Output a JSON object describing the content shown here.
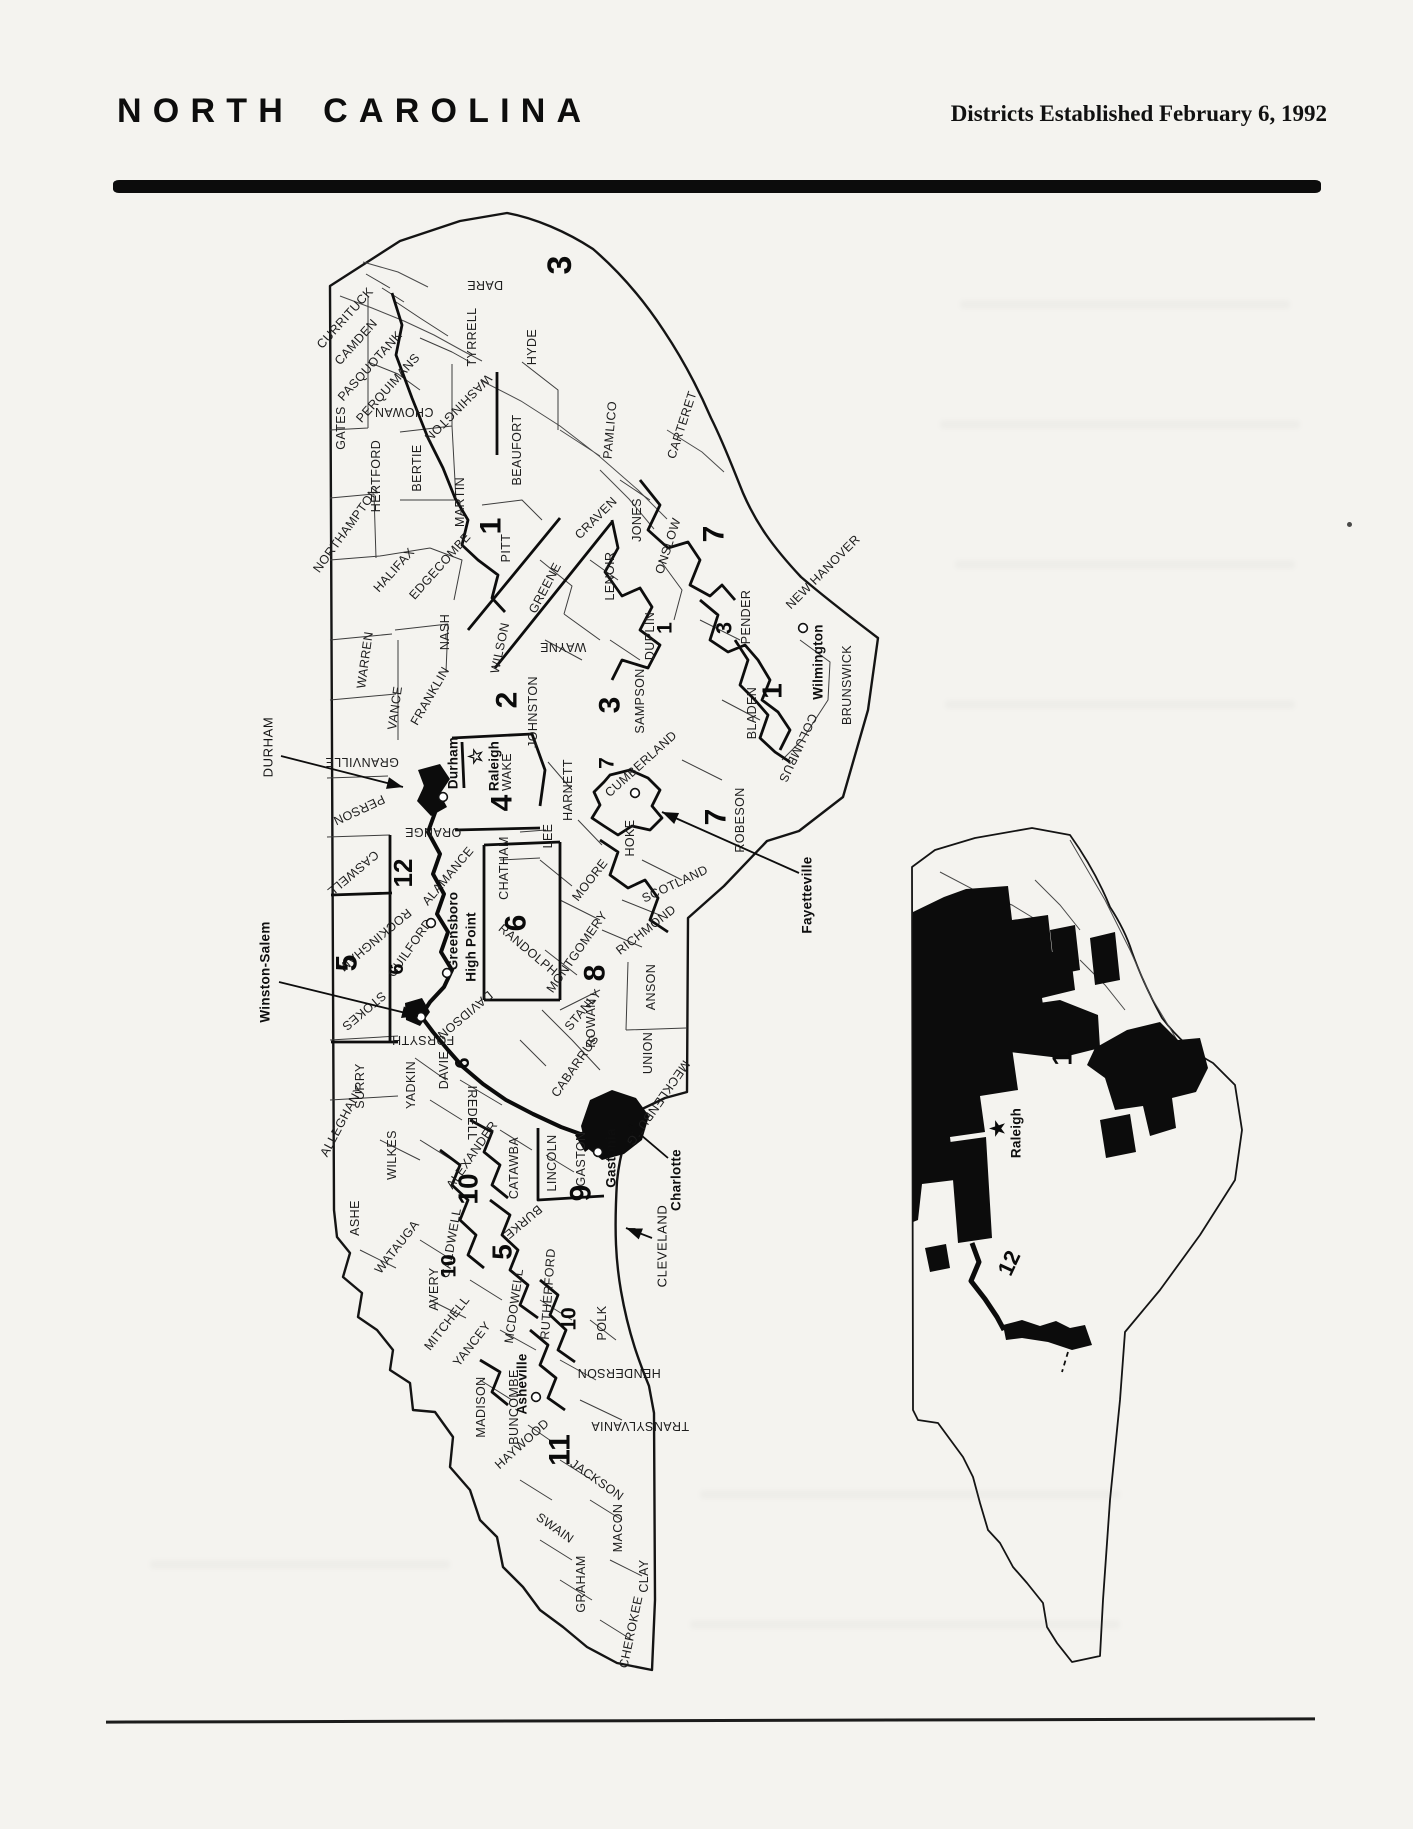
{
  "header": {
    "title": "NORTH CAROLINA",
    "subtitle": "Districts Established February 6, 1992"
  },
  "main_map": {
    "county_labels": [
      {
        "t": "CURRITUCK",
        "x": 345,
        "y": 318,
        "r": -48
      },
      {
        "t": "CAMDEN",
        "x": 356,
        "y": 342,
        "r": -48
      },
      {
        "t": "PASQUOTANK",
        "x": 370,
        "y": 366,
        "r": -48
      },
      {
        "t": "PERQUIMANS",
        "x": 388,
        "y": 388,
        "r": -48
      },
      {
        "t": "CHOWAN",
        "x": 404,
        "y": 412,
        "r": 180
      },
      {
        "t": "GATES",
        "x": 341,
        "y": 428,
        "r": -90
      },
      {
        "t": "DARE",
        "x": 485,
        "y": 285,
        "r": 180
      },
      {
        "t": "TYRRELL",
        "x": 472,
        "y": 337,
        "r": -90
      },
      {
        "t": "HYDE",
        "x": 532,
        "y": 347,
        "r": -90
      },
      {
        "t": "WASHINGTON",
        "x": 458,
        "y": 408,
        "r": 135
      },
      {
        "t": "HERTFORD",
        "x": 376,
        "y": 476,
        "r": -90
      },
      {
        "t": "BERTIE",
        "x": 417,
        "y": 468,
        "r": -90
      },
      {
        "t": "NORTHAMPTON",
        "x": 346,
        "y": 530,
        "r": -54
      },
      {
        "t": "HALIFAX",
        "x": 394,
        "y": 570,
        "r": -48
      },
      {
        "t": "EDGECOMBE",
        "x": 440,
        "y": 566,
        "r": -48
      },
      {
        "t": "MARTIN",
        "x": 460,
        "y": 502,
        "r": -90
      },
      {
        "t": "PITT",
        "x": 506,
        "y": 548,
        "r": -90
      },
      {
        "t": "BEAUFORT",
        "x": 517,
        "y": 450,
        "r": -90
      },
      {
        "t": "PAMLICO",
        "x": 610,
        "y": 430,
        "r": -85
      },
      {
        "t": "CARTERET",
        "x": 682,
        "y": 425,
        "r": -72
      },
      {
        "t": "CRAVEN",
        "x": 596,
        "y": 518,
        "r": -45
      },
      {
        "t": "JONES",
        "x": 637,
        "y": 520,
        "r": -90
      },
      {
        "t": "GREENE",
        "x": 545,
        "y": 588,
        "r": -62
      },
      {
        "t": "LENOIR",
        "x": 610,
        "y": 576,
        "r": -90
      },
      {
        "t": "ONSLOW",
        "x": 668,
        "y": 546,
        "r": -72
      },
      {
        "t": "DUPLIN",
        "x": 650,
        "y": 636,
        "r": -90
      },
      {
        "t": "PENDER",
        "x": 746,
        "y": 617,
        "r": -90
      },
      {
        "t": "NEW HANOVER",
        "x": 823,
        "y": 572,
        "r": -45
      },
      {
        "t": "BRUNSWICK",
        "x": 847,
        "y": 685,
        "r": -90
      },
      {
        "t": "COLUMBUS",
        "x": 798,
        "y": 748,
        "r": 115
      },
      {
        "t": "BLADEN",
        "x": 752,
        "y": 713,
        "r": -90
      },
      {
        "t": "SAMPSON",
        "x": 640,
        "y": 701,
        "r": -90
      },
      {
        "t": "WAYNE",
        "x": 563,
        "y": 647,
        "r": 180
      },
      {
        "t": "WILSON",
        "x": 500,
        "y": 648,
        "r": -78
      },
      {
        "t": "NASH",
        "x": 445,
        "y": 632,
        "r": -90
      },
      {
        "t": "WARREN",
        "x": 365,
        "y": 660,
        "r": -82
      },
      {
        "t": "VANCE",
        "x": 395,
        "y": 708,
        "r": -82
      },
      {
        "t": "FRANKLIN",
        "x": 430,
        "y": 696,
        "r": -60
      },
      {
        "t": "GRANVILLE",
        "x": 362,
        "y": 762,
        "r": 180
      },
      {
        "t": "PERSON",
        "x": 359,
        "y": 810,
        "r": 155
      },
      {
        "t": "CASWELL",
        "x": 353,
        "y": 873,
        "r": 140
      },
      {
        "t": "ORANGE",
        "x": 433,
        "y": 832,
        "r": 180
      },
      {
        "t": "ALAMANCE",
        "x": 448,
        "y": 876,
        "r": -50
      },
      {
        "t": "WAKE",
        "x": 507,
        "y": 772,
        "r": -90
      },
      {
        "t": "JOHNSTON",
        "x": 533,
        "y": 712,
        "r": -90
      },
      {
        "t": "HARNETT",
        "x": 568,
        "y": 790,
        "r": -90
      },
      {
        "t": "CUMBERLAND",
        "x": 641,
        "y": 764,
        "r": -42
      },
      {
        "t": "HOKE",
        "x": 630,
        "y": 838,
        "r": -90
      },
      {
        "t": "ROBESON",
        "x": 740,
        "y": 820,
        "r": -90
      },
      {
        "t": "SCOTLAND",
        "x": 675,
        "y": 884,
        "r": -25
      },
      {
        "t": "RICHMOND",
        "x": 646,
        "y": 930,
        "r": -38
      },
      {
        "t": "MOORE",
        "x": 590,
        "y": 880,
        "r": -52
      },
      {
        "t": "LEE",
        "x": 548,
        "y": 836,
        "r": -90
      },
      {
        "t": "CHATHAM",
        "x": 504,
        "y": 868,
        "r": -90
      },
      {
        "t": "MONTGOMERY",
        "x": 577,
        "y": 952,
        "r": -55
      },
      {
        "t": "STANLY",
        "x": 583,
        "y": 1010,
        "r": -50
      },
      {
        "t": "ANSON",
        "x": 651,
        "y": 987,
        "r": -90
      },
      {
        "t": "UNION",
        "x": 648,
        "y": 1053,
        "r": -90
      },
      {
        "t": "CABARRUS",
        "x": 575,
        "y": 1066,
        "r": -55
      },
      {
        "t": "ROWAN",
        "x": 591,
        "y": 1023,
        "r": -90
      },
      {
        "t": "DAVIDSON",
        "x": 465,
        "y": 1015,
        "r": 140
      },
      {
        "t": "RANDOLPH",
        "x": 528,
        "y": 950,
        "r": 40
      },
      {
        "t": "GUILFORD",
        "x": 410,
        "y": 948,
        "r": -55
      },
      {
        "t": "ROCKINGHAM",
        "x": 375,
        "y": 940,
        "r": 140
      },
      {
        "t": "STOKES",
        "x": 364,
        "y": 1011,
        "r": 140
      },
      {
        "t": "SURRY",
        "x": 360,
        "y": 1086,
        "r": -90
      },
      {
        "t": "YADKIN",
        "x": 411,
        "y": 1085,
        "r": -90
      },
      {
        "t": "DAVIE",
        "x": 444,
        "y": 1070,
        "r": -90
      },
      {
        "t": "FORSYTH",
        "x": 423,
        "y": 1040,
        "r": 180
      },
      {
        "t": "IREDELL",
        "x": 472,
        "y": 1113,
        "r": 90
      },
      {
        "t": "MECKLENBURG",
        "x": 658,
        "y": 1103,
        "r": 125
      },
      {
        "t": "GASTON",
        "x": 581,
        "y": 1159,
        "r": -90
      },
      {
        "t": "LINCOLN",
        "x": 552,
        "y": 1163,
        "r": -90
      },
      {
        "t": "CATAWBA",
        "x": 514,
        "y": 1168,
        "r": -90
      },
      {
        "t": "ALEXANDER",
        "x": 472,
        "y": 1155,
        "r": -55
      },
      {
        "t": "WILKES",
        "x": 392,
        "y": 1155,
        "r": -90
      },
      {
        "t": "ALLEGHANY",
        "x": 342,
        "y": 1121,
        "r": -62
      },
      {
        "t": "ASHE",
        "x": 355,
        "y": 1218,
        "r": -90
      },
      {
        "t": "WATAUGA",
        "x": 397,
        "y": 1247,
        "r": -52
      },
      {
        "t": "CALDWELL",
        "x": 451,
        "y": 1243,
        "r": -80
      },
      {
        "t": "AVERY",
        "x": 434,
        "y": 1289,
        "r": -90
      },
      {
        "t": "BURKE",
        "x": 523,
        "y": 1222,
        "r": 140
      },
      {
        "t": "MITCHELL",
        "x": 447,
        "y": 1323,
        "r": -52
      },
      {
        "t": "YANCEY",
        "x": 472,
        "y": 1344,
        "r": -52
      },
      {
        "t": "MCDOWELL",
        "x": 514,
        "y": 1306,
        "r": -82
      },
      {
        "t": "RUTHERFORD",
        "x": 548,
        "y": 1294,
        "r": -86
      },
      {
        "t": "POLK",
        "x": 602,
        "y": 1323,
        "r": -90
      },
      {
        "t": "HENDERSON",
        "x": 619,
        "y": 1373,
        "r": 180
      },
      {
        "t": "MADISON",
        "x": 481,
        "y": 1407,
        "r": -90
      },
      {
        "t": "BUNCOMBE",
        "x": 514,
        "y": 1407,
        "r": -90
      },
      {
        "t": "HAYWOOD",
        "x": 522,
        "y": 1444,
        "r": -42
      },
      {
        "t": "TRANSYLVANIA",
        "x": 640,
        "y": 1426,
        "r": 180
      },
      {
        "t": "JACKSON",
        "x": 597,
        "y": 1480,
        "r": 35
      },
      {
        "t": "SWAIN",
        "x": 555,
        "y": 1528,
        "r": 35
      },
      {
        "t": "MACON",
        "x": 618,
        "y": 1528,
        "r": -90
      },
      {
        "t": "GRAHAM",
        "x": 581,
        "y": 1584,
        "r": -90
      },
      {
        "t": "CLAY",
        "x": 644,
        "y": 1576,
        "r": -90
      },
      {
        "t": "CHEROKEE",
        "x": 631,
        "y": 1632,
        "r": -78
      }
    ],
    "district_labels": [
      {
        "t": "3",
        "x": 560,
        "y": 265,
        "r": -90,
        "s": 34
      },
      {
        "t": "1",
        "x": 491,
        "y": 526,
        "r": -90,
        "s": 30
      },
      {
        "t": "7",
        "x": 714,
        "y": 534,
        "r": -90,
        "s": 30
      },
      {
        "t": "1",
        "x": 665,
        "y": 628,
        "r": -90,
        "s": 21
      },
      {
        "t": "3",
        "x": 724,
        "y": 628,
        "r": -90,
        "s": 22
      },
      {
        "t": "2",
        "x": 507,
        "y": 700,
        "r": -90,
        "s": 30
      },
      {
        "t": "3",
        "x": 610,
        "y": 705,
        "r": -90,
        "s": 30
      },
      {
        "t": "1",
        "x": 772,
        "y": 691,
        "r": -90,
        "s": 28
      },
      {
        "t": "7",
        "x": 607,
        "y": 763,
        "r": -90,
        "s": 21
      },
      {
        "t": "7",
        "x": 716,
        "y": 817,
        "r": -90,
        "s": 30
      },
      {
        "t": "4",
        "x": 502,
        "y": 803,
        "r": -90,
        "s": 30
      },
      {
        "t": "12",
        "x": 403,
        "y": 873,
        "r": -90,
        "s": 26
      },
      {
        "t": "5",
        "x": 347,
        "y": 963,
        "r": -90,
        "s": 30
      },
      {
        "t": "6",
        "x": 397,
        "y": 969,
        "r": -90,
        "s": 20
      },
      {
        "t": "6",
        "x": 516,
        "y": 923,
        "r": -90,
        "s": 30
      },
      {
        "t": "8",
        "x": 595,
        "y": 973,
        "r": -90,
        "s": 30
      },
      {
        "t": "6",
        "x": 463,
        "y": 1063,
        "r": -90,
        "s": 20
      },
      {
        "t": "10",
        "x": 468,
        "y": 1189,
        "r": -90,
        "s": 28
      },
      {
        "t": "9",
        "x": 581,
        "y": 1193,
        "r": -90,
        "s": 30
      },
      {
        "t": "5",
        "x": 502,
        "y": 1252,
        "r": -90,
        "s": 28
      },
      {
        "t": "10",
        "x": 449,
        "y": 1266,
        "r": -90,
        "s": 21
      },
      {
        "t": "10",
        "x": 569,
        "y": 1319,
        "r": -90,
        "s": 21
      },
      {
        "t": "11",
        "x": 560,
        "y": 1450,
        "r": -90,
        "s": 30
      }
    ],
    "city_labels": [
      {
        "t": "Raleigh",
        "x": 494,
        "y": 766,
        "r": -90
      },
      {
        "t": "Durham",
        "x": 453,
        "y": 763,
        "r": -90
      },
      {
        "t": "Greensboro",
        "x": 453,
        "y": 931,
        "r": -90
      },
      {
        "t": "High Point",
        "x": 471,
        "y": 947,
        "r": -90
      },
      {
        "t": "Wilmington",
        "x": 818,
        "y": 662,
        "r": -90
      },
      {
        "t": "Gastonia",
        "x": 611,
        "y": 1158,
        "r": -90
      },
      {
        "t": "Asheville",
        "x": 522,
        "y": 1384,
        "r": -90
      }
    ],
    "markers": [
      {
        "type": "star",
        "glyph": "☆",
        "x": 476,
        "y": 757
      },
      {
        "type": "circle",
        "x": 443,
        "y": 797
      },
      {
        "type": "circle",
        "x": 431,
        "y": 923
      },
      {
        "type": "circle",
        "x": 447,
        "y": 973
      },
      {
        "type": "circle",
        "x": 421,
        "y": 1017
      },
      {
        "type": "circle",
        "x": 598,
        "y": 1152
      },
      {
        "type": "circle",
        "x": 536,
        "y": 1397
      },
      {
        "type": "circle",
        "x": 803,
        "y": 628
      },
      {
        "type": "circle",
        "x": 635,
        "y": 793
      }
    ],
    "callouts": [
      {
        "t": "DURHAM",
        "x": 268,
        "y": 747,
        "r": -90,
        "b": 0,
        "ax1": 281,
        "ay1": 756,
        "ax2": 403,
        "ay2": 787
      },
      {
        "t": "Winston-Salem",
        "x": 265,
        "y": 972,
        "r": -90,
        "b": 1,
        "ax1": 279,
        "ay1": 982,
        "ax2": 418,
        "ay2": 1016
      },
      {
        "t": "Fayetteville",
        "x": 807,
        "y": 895,
        "r": -90,
        "b": 1,
        "ax1": 799,
        "ay1": 873,
        "ax2": 662,
        "ay2": 812
      },
      {
        "t": "Charlotte",
        "x": 676,
        "y": 1180,
        "r": -90,
        "b": 1,
        "ax1": 668,
        "ay1": 1158,
        "ax2": 628,
        "ay2": 1124
      },
      {
        "t": "CLEVELAND",
        "x": 662,
        "y": 1246,
        "r": -90,
        "b": 0,
        "ax1": 652,
        "ay1": 1238,
        "ax2": 626,
        "ay2": 1228
      }
    ]
  },
  "inset_map": {
    "district_labels": [
      {
        "t": "1",
        "x": 1062,
        "y": 1058,
        "r": -90,
        "s": 28
      },
      {
        "t": "12",
        "x": 1009,
        "y": 1263,
        "r": -65,
        "s": 22
      }
    ],
    "city_labels": [
      {
        "t": "Raleigh",
        "x": 1016,
        "y": 1133,
        "r": -90
      }
    ],
    "markers": [
      {
        "type": "star",
        "glyph": "★",
        "x": 998,
        "y": 1129
      }
    ]
  }
}
